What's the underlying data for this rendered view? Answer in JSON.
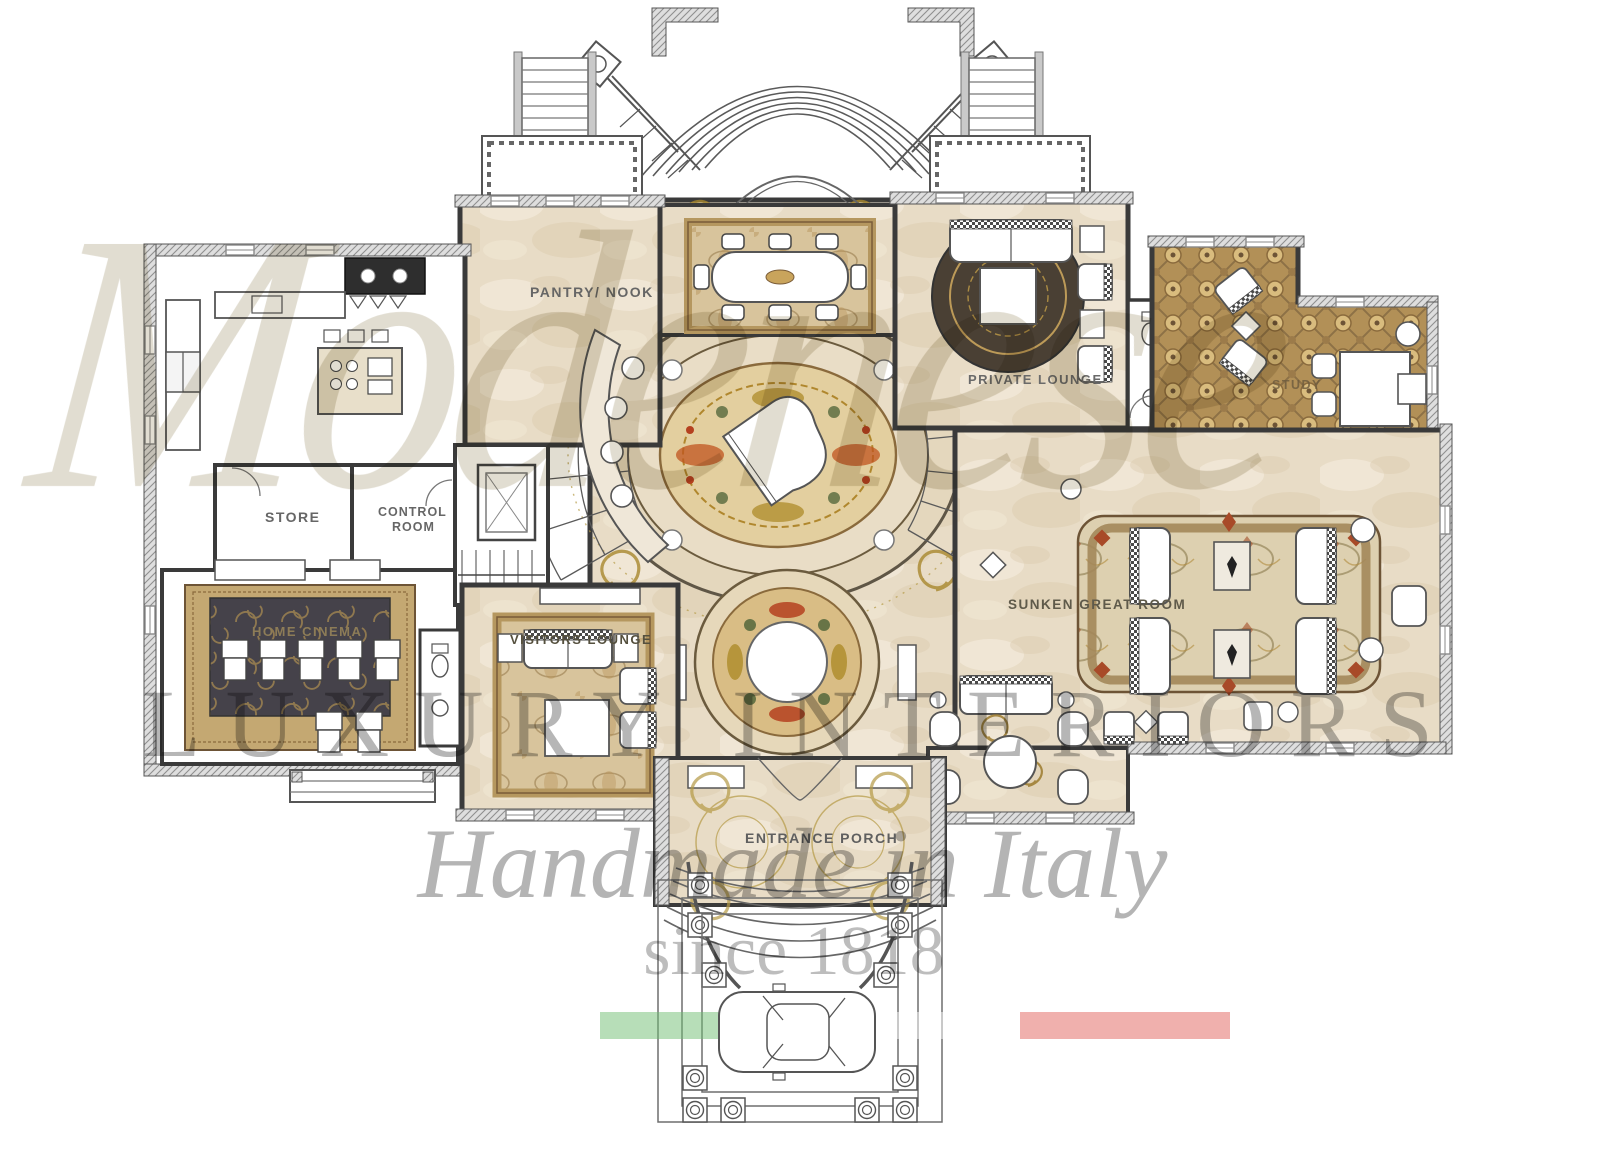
{
  "watermark": {
    "script": "Modenese",
    "luxury": "LUXURY INTERIORS",
    "handmade": "Handmade in Italy",
    "since": "since 1818",
    "flag": {
      "green": "#6fbe72",
      "white": "#ffffff",
      "red": "#e2625c"
    }
  },
  "rooms": {
    "pantry_nook": "PANTRY/ NOOK",
    "store": "STORE",
    "control_line1": "CONTROL",
    "control_line2": "ROOM",
    "home_cinema": "HOME CINEMA",
    "visitors_lounge": "VISITORS LOUNGE",
    "private_lounge": "PRIVATE LOUNGE",
    "study": "STUDY",
    "sunken_great_room": "SUNKEN GREAT ROOM",
    "entrance_porch": "ENTRANCE PORCH"
  },
  "palette": {
    "marble": "#e8dcc6",
    "wall": "#3a3a3a",
    "rug_gold": "#b5975f",
    "cinema_rug": "#45424a",
    "medallion_red": "#b5411f",
    "medallion_gold": "#b58a2e",
    "medallion_green": "#55683c"
  }
}
